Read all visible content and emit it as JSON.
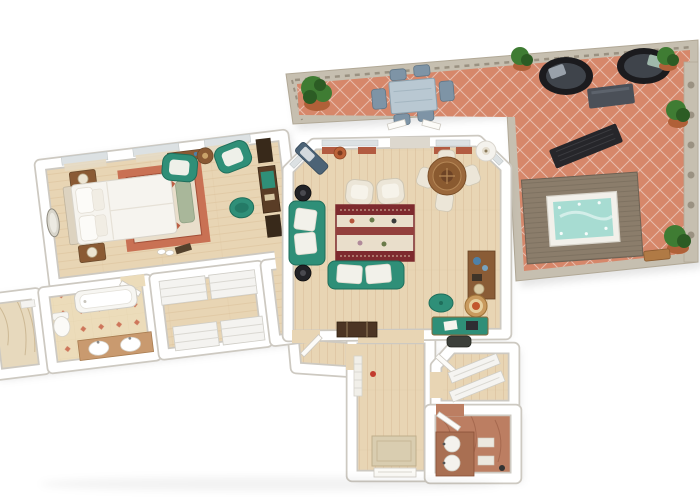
{
  "scene": {
    "type": "3d-floor-plan-render",
    "description": "Top-down 3D rendered floor plan of an apartment with a large tiled terrace",
    "rooms": [
      {
        "id": "terrace",
        "label": "Terrace",
        "floor": "terracotta-diamond-tile",
        "furniture": [
          "outdoor-dining-table",
          "outdoor-chairs",
          "round-daybed",
          "round-daybed",
          "ottoman-tray",
          "sun-lounger",
          "hot-tub",
          "potted-plants",
          "stone-balustrade",
          "garden-bench"
        ]
      },
      {
        "id": "bedroom",
        "label": "Bedroom",
        "floor": "light-wood-plank",
        "furniture": [
          "double-bed",
          "headboard",
          "nightstand-left",
          "nightstand-right",
          "table-lamps",
          "oval-mirror",
          "oriental-rug",
          "foot-bench",
          "teal-armchair",
          "teal-armchair",
          "round-side-table",
          "writing-desk",
          "desk-chair",
          "bookcase",
          "bookcase",
          "console-table",
          "slippers"
        ]
      },
      {
        "id": "living-room",
        "label": "Living Room",
        "floor": "light-wood-plank",
        "furniture": [
          "teal-sofa-vertical",
          "teal-sofa-horizontal",
          "ornate-area-rug",
          "cream-armchair",
          "cream-armchair",
          "round-dining-table",
          "dining-chairs",
          "floor-lamp",
          "corner-bench",
          "black-side-table",
          "black-side-table",
          "storage-trunk",
          "wood-console",
          "teal-pouf",
          "wicker-chair",
          "teal-desk",
          "desk-chair",
          "orange-planter"
        ]
      },
      {
        "id": "bathroom-main",
        "label": "Bathroom",
        "floor": "patterned-beige-tile",
        "furniture": [
          "bathtub",
          "double-vanity",
          "toilet"
        ]
      },
      {
        "id": "walk-in-closet",
        "label": "Walk-in Closet",
        "floor": "light-wood-plank",
        "furniture": [
          "wardrobe-unit",
          "wardrobe-unit",
          "wardrobe-unit",
          "wardrobe-unit"
        ]
      },
      {
        "id": "side-hall",
        "label": "Side Hall",
        "floor": "beige-marble",
        "furniture": [
          "wall-shelf"
        ]
      },
      {
        "id": "vestibule",
        "label": "Vestibule",
        "floor": "light-wood-plank",
        "furniture": []
      },
      {
        "id": "entry-hall",
        "label": "Entry Hall",
        "floor": "light-wood-plank",
        "furniture": [
          "doormat",
          "entry-door",
          "radiator",
          "red-decor"
        ]
      },
      {
        "id": "closet-2",
        "label": "Closet",
        "floor": "light-wood-plank",
        "furniture": [
          "shelf-rack",
          "shelf-rack"
        ]
      },
      {
        "id": "bathroom-2",
        "label": "Guest Bathroom",
        "floor": "red-marble",
        "furniture": [
          "double-sink-vanity",
          "towel-shelf",
          "door"
        ]
      }
    ]
  },
  "palette": {
    "wall": "#ffffff",
    "wallline": "#cdc9c1",
    "wood": "#e8d5b4",
    "woodline": "#d8bd98",
    "tile": "#d6876a",
    "stone": "#c6bfb0",
    "stonedark": "#9a9181",
    "teal": "#2f8f78",
    "tealdark": "#1f6e5b",
    "sage": "#a9b79a",
    "rugred": "#c97154",
    "rugcream": "#e9decb",
    "maroon": "#7e2a2e",
    "maroon2": "#93403d",
    "cream": "#ece6d8",
    "creamline": "#cfc7b4",
    "woodmid": "#8a5a34",
    "wooddark": "#5a3d26",
    "black": "#222226",
    "bluegrey": "#7e94a6",
    "glass": "#b9c8d2",
    "greycushion": "#3f444b",
    "pillowgrey": "#99a1aa",
    "plant": "#3f7c33",
    "plantdark": "#2c5c24",
    "pot": "#b06038",
    "water": "#a7dcd2",
    "deck": "#8b7d6b",
    "deckline": "#6e6254",
    "bathfloor": "#ecdcba",
    "bathmotif": "#c4543a",
    "marblebeige": "#e7d9bd",
    "marblered": "#bc7e62",
    "marblereddark": "#94573f",
    "mat": "#d9cdb0",
    "curtain": "#e6dac3",
    "curtain2": "#b25b41",
    "glazing": "#dce1e3",
    "slate": "#4c6376",
    "slatecushion": "#d3d9dd",
    "wicker": "#c99a5e",
    "wickerdark": "#9e7238",
    "orange": "#c2572e",
    "white2": "#f6f4ef",
    "shadow": "rgba(0,0,0,0.10)"
  }
}
